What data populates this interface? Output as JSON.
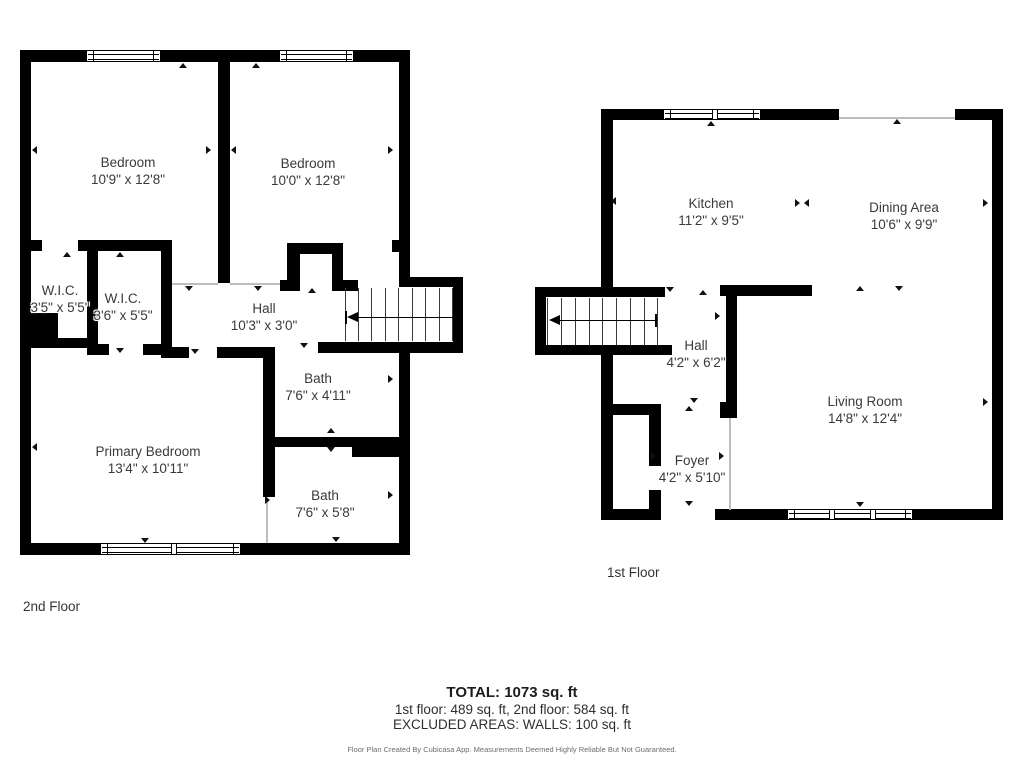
{
  "floors": {
    "second": {
      "label": "2nd Floor",
      "rooms": [
        {
          "name": "Bedroom",
          "dims": "10'9\" x 12'8\""
        },
        {
          "name": "Bedroom",
          "dims": "10'0\" x 12'8\""
        },
        {
          "name": "W.I.C.",
          "dims": "3'5\" x 5'5\""
        },
        {
          "name": "W.I.C.",
          "dims": "3'6\" x 5'5\""
        },
        {
          "name": "Hall",
          "dims": "10'3\" x 3'0\""
        },
        {
          "name": "Bath",
          "dims": "7'6\" x 4'11\""
        },
        {
          "name": "Primary Bedroom",
          "dims": "13'4\" x 10'11\""
        },
        {
          "name": "Bath",
          "dims": "7'6\" x 5'8\""
        }
      ]
    },
    "first": {
      "label": "1st Floor",
      "rooms": [
        {
          "name": "Kitchen",
          "dims": "11'2\" x 9'5\""
        },
        {
          "name": "Dining Area",
          "dims": "10'6\" x 9'9\""
        },
        {
          "name": "Hall",
          "dims": "4'2\" x 6'2\""
        },
        {
          "name": "Living Room",
          "dims": "14'8\" x 12'4\""
        },
        {
          "name": "Foyer",
          "dims": "4'2\" x 5'10\""
        }
      ]
    }
  },
  "summary": {
    "total": "TOTAL: 1073 sq. ft",
    "floors_line": "1st floor: 489 sq. ft, 2nd floor: 584 sq. ft",
    "excluded_line": "EXCLUDED AREAS: WALLS: 100 sq. ft",
    "disclaimer": "Floor Plan Created By Cubicasa App. Measurements Deemed Highly Reliable But Not Guaranteed."
  },
  "colors": {
    "wall": "#000000",
    "text": "#3a3a3a",
    "disclaimer": "#6e6e6e"
  }
}
